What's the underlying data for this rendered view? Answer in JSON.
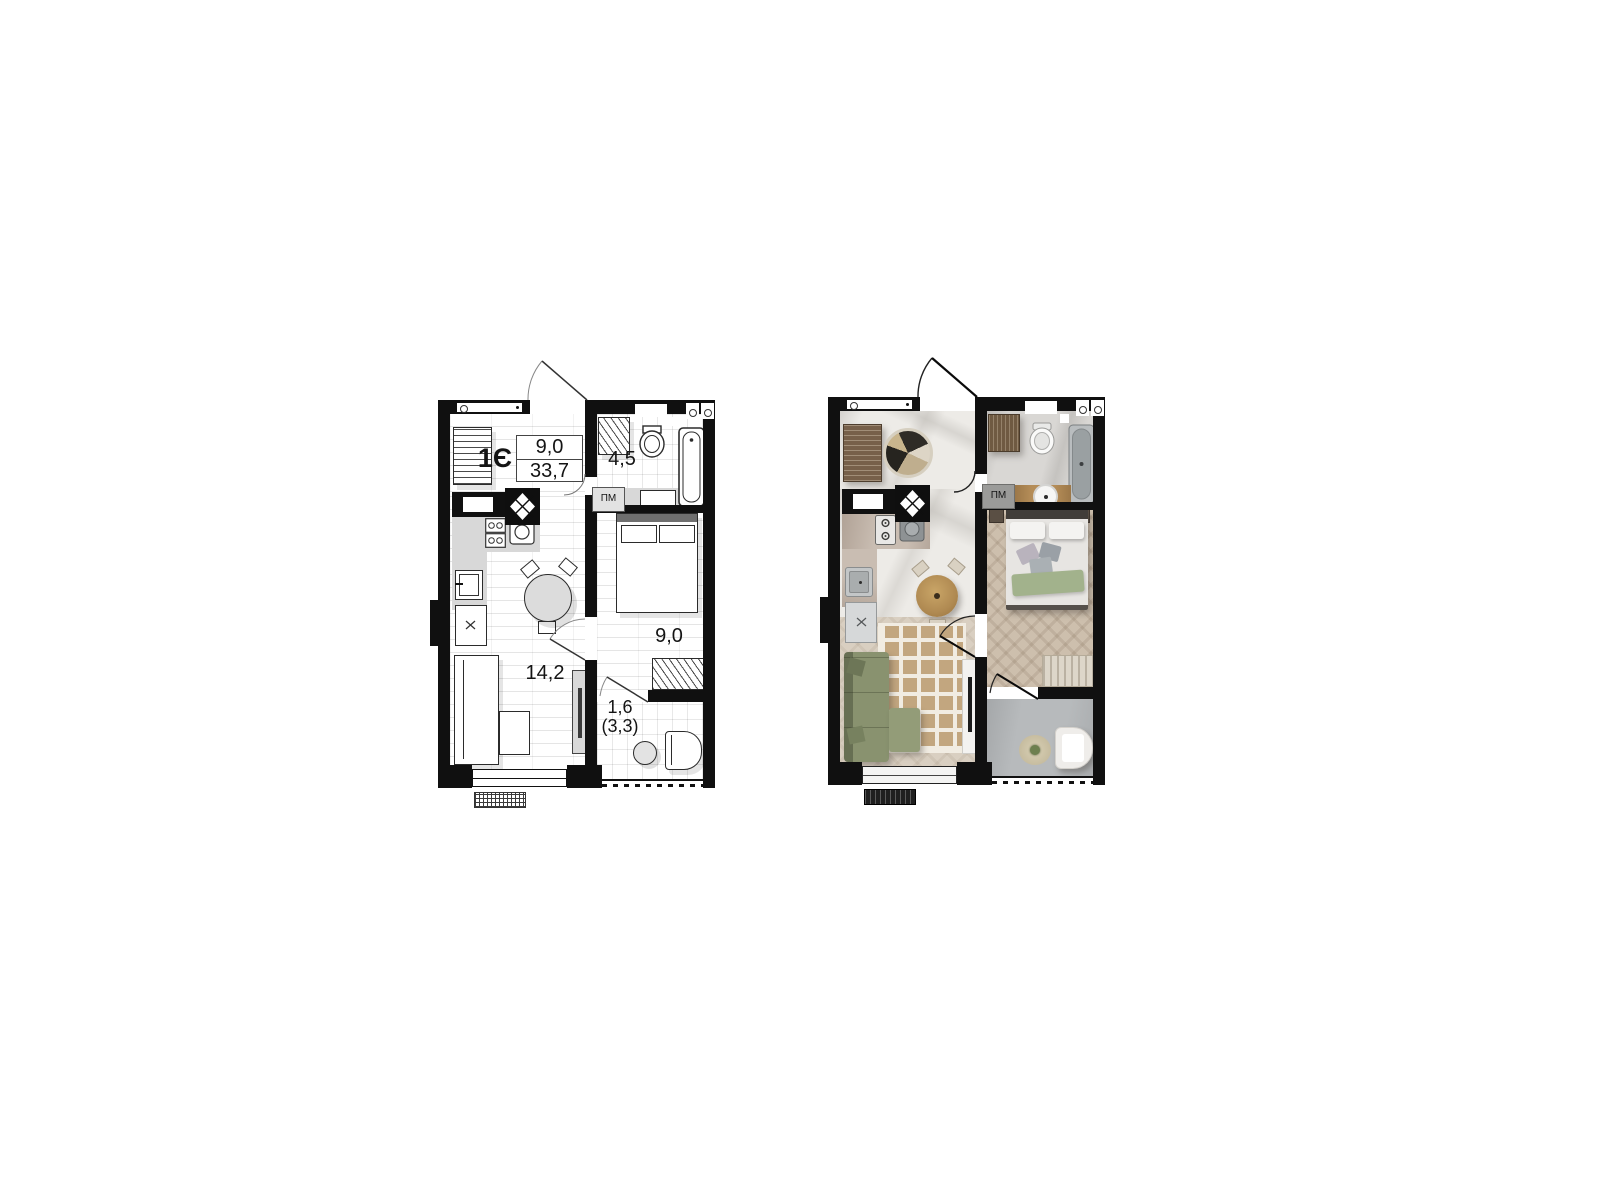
{
  "page": {
    "background_color": "#ffffff"
  },
  "plan_schematic": {
    "unit_label": "1Є",
    "area_summary": {
      "room_area": "9,0",
      "total_area": "33,7"
    },
    "bathroom_area": "4,5",
    "bedroom_area": "9,0",
    "living_kitchen_area": "14,2",
    "balcony_area": "1,6",
    "balcony_area_full": "(3,3)",
    "washing_machine_label": "ПМ"
  },
  "plan_furnished": {
    "washing_machine_label": "ПМ"
  },
  "colors": {
    "wall": "#101010",
    "schematic_line": "#2b2b2b",
    "counter_grey": "#d8d8d8",
    "marble_light": "#edebe7",
    "marble_grey": "#d9d7d4",
    "wood_floor": "#d9cfc1",
    "herringbone_floor": "#cdbfad",
    "balcony_concrete": "#b7babc",
    "sofa_green": "#89926f",
    "rug_tan": "#c2a67f",
    "table_wood": "#b08a52",
    "wardrobe_wood": "#77604a",
    "bed_linen": "#e7e5e2",
    "throw_green": "#a2b28c",
    "bathtub_grey": "#9aa0a2"
  }
}
